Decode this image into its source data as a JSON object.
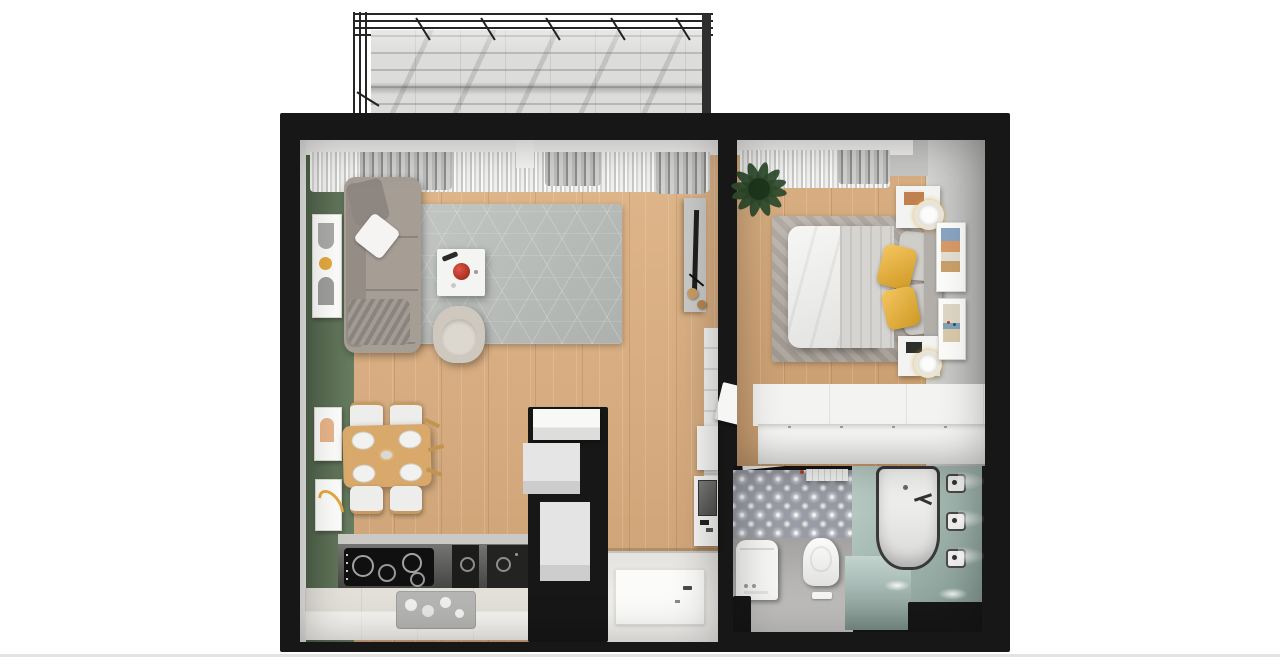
{
  "scene": {
    "title": "apartment-3d-floor-plan-render",
    "canvas": {
      "width": 1280,
      "height": 667
    }
  },
  "palette": {
    "background": "#ffffff",
    "wall": "#171717",
    "wood_floor": "#dcae7e",
    "wood_floor_bedroom": "#d5a776",
    "green_wall": "#5e7457",
    "gray_wall": "#c6c6c4",
    "balcony_floor": "#dcdcda",
    "window_ledge": "#efeeec",
    "rug_living": "#bcc0bd",
    "rug_bedroom": "#b3aaa2",
    "sofa": "#a69d95",
    "sofa_blanket": "#978f88",
    "armchair": "#cec8bf",
    "coffee_table": "#f4f4f2",
    "accent_red": "#c13a2e",
    "dining_wood": "#d9a96c",
    "chair_seat": "#ededeb",
    "counter_dark": "#565654",
    "counter_white": "#ece9e2",
    "cooktop_black": "#101010",
    "appliance_black": "#1c1c1b",
    "sink_steel": "#b5b5b3",
    "white_furniture": "#f3f3f1",
    "gray_closet": "#dedede",
    "entry_floor": "#f0efeb",
    "doormat": "#fbfbf9",
    "bed_duvet": "#ededeb",
    "bed_blanket": "#d6d4d0",
    "pillow_yellow": "#f2b32a",
    "pillow_gray": "#d0cec9",
    "headboard": "#b2afab",
    "plant_green": "#2d4a2c",
    "lamp_gold": "#d2a14a",
    "tile_base": "#999ca4",
    "bath_floor_gray": "#b5b4b2",
    "tub_deck_teal": "#a3bdb5",
    "tub_white": "#f5f5f3",
    "tub_rim": "#39393a",
    "art_yellow": "#e2a83d",
    "art_peach": "#e8b489",
    "mirror_gray": "#6b6b69"
  },
  "rooms": {
    "balcony": {
      "id": "balcony",
      "items": [
        "pergola-grid",
        "stone-tile-floor"
      ]
    },
    "living_room": {
      "id": "living-room",
      "items": [
        "sofa",
        "throw-pillows",
        "plaid",
        "hex-area-rug",
        "coffee-table",
        "red-bowl",
        "armchair",
        "tv-unit",
        "wall-art-frames",
        "dining-table",
        "dining-chairs",
        "window-curtains"
      ]
    },
    "kitchen": {
      "id": "kitchen",
      "items": [
        "cooktop",
        "built-in-oven",
        "built-in-appliance",
        "dark-countertop",
        "white-countertop",
        "sink-dish-rack",
        "tall-cabinet"
      ]
    },
    "hallway": {
      "id": "entry-hallway",
      "items": [
        "storage-closets",
        "console-with-mirror",
        "doormat",
        "open-doors"
      ]
    },
    "bedroom": {
      "id": "bedroom",
      "items": [
        "double-bed",
        "duvet",
        "yellow-pillows",
        "gray-pillows",
        "headboard",
        "nightstands",
        "ring-lamps",
        "area-rug",
        "wardrobe",
        "potted-plant",
        "wall-pictures",
        "window-curtains"
      ]
    },
    "bathroom": {
      "id": "bathroom",
      "items": [
        "bathtub",
        "teal-tub-deck",
        "toilet",
        "flush-plate",
        "washing-machine",
        "patterned-tile-floor",
        "wall-sconces",
        "radiator",
        "shower-handle"
      ]
    }
  }
}
